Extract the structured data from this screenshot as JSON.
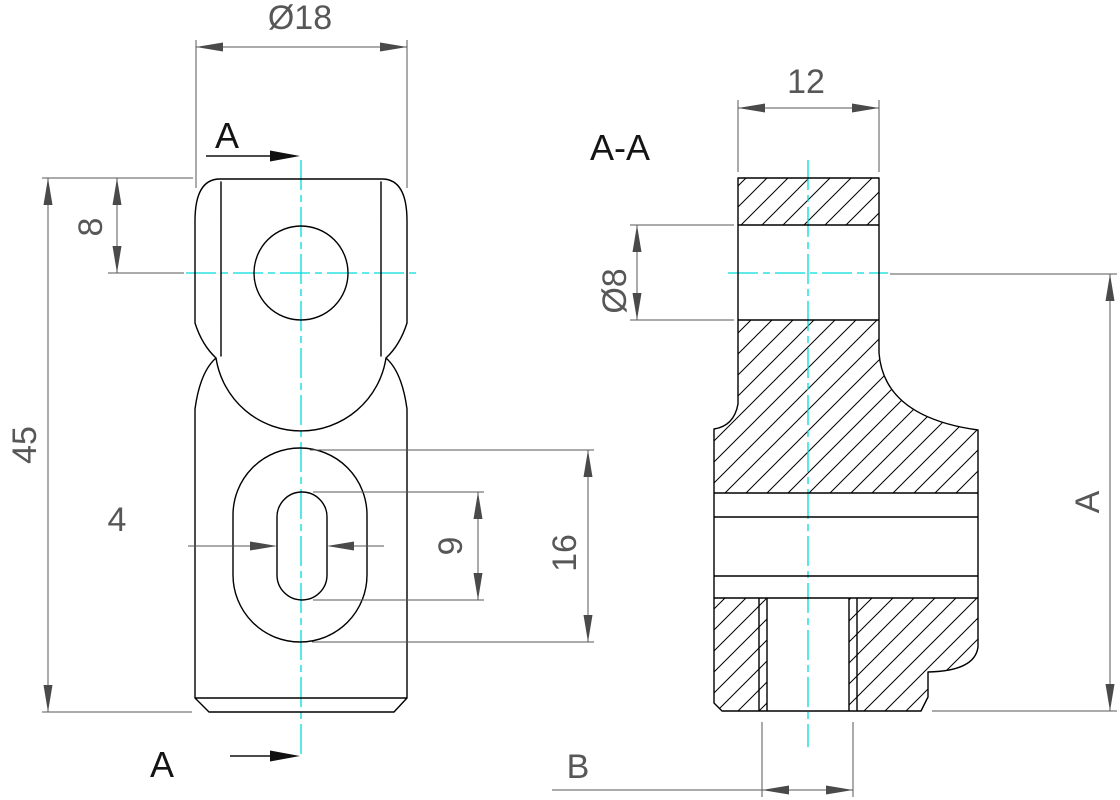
{
  "drawing_title": "Two-view mechanical part drawing with section A-A",
  "colors": {
    "outline": "#000000",
    "dimension": "#575757",
    "centerline": "#00dcdc",
    "label": "#141414",
    "background": "#ffffff"
  },
  "front_view": {
    "cut_label_top": "A",
    "cut_label_bottom": "A",
    "dims": {
      "boss_diameter": "Ø18",
      "total_height": "45",
      "hole_offset": "8",
      "slot_width": "4",
      "slot_length": "9",
      "pocket_length": "16"
    }
  },
  "section_view": {
    "label": "A-A",
    "dims": {
      "depth": "12",
      "hole_diameter": "Ø8",
      "height_ref": "A",
      "slot_ref": "B"
    }
  }
}
